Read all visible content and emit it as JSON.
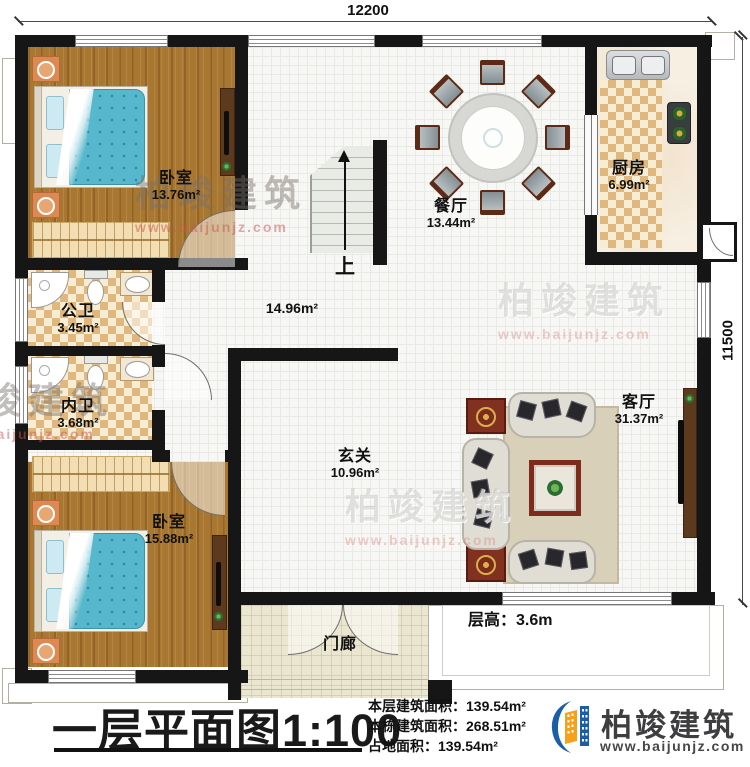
{
  "dimensions": {
    "top": "12200",
    "right": "11500"
  },
  "rooms": {
    "bedroom1": {
      "name": "卧室",
      "area": "13.76m²"
    },
    "bath_public": {
      "name": "公卫",
      "area": "3.45m²"
    },
    "bath_inner": {
      "name": "内卫",
      "area": "3.68m²"
    },
    "bedroom2": {
      "name": "卧室",
      "area": "15.88m²"
    },
    "dining": {
      "name": "餐厅",
      "area": "13.44m²"
    },
    "kitchen": {
      "name": "厨房",
      "area": "6.99m²"
    },
    "hall": {
      "area": "14.96m²"
    },
    "foyer": {
      "name": "玄关",
      "area": "10.96m²"
    },
    "living": {
      "name": "客厅",
      "area": "31.37m²"
    },
    "porch": {
      "name": "门廊"
    }
  },
  "stairs": {
    "up_label": "上"
  },
  "notes": {
    "floor_height_label": "层高：",
    "floor_height_value": "3.6m"
  },
  "title_block": {
    "title": "一层平面图",
    "scale": "1:100",
    "stats": [
      {
        "label": "本层建筑面积：",
        "value": "139.54m²"
      },
      {
        "label": "本栋建筑面积：",
        "value": "268.51m²"
      },
      {
        "label": "占地面积：",
        "value": "139.54m²"
      }
    ],
    "brand": {
      "name": "柏竣建筑",
      "url": "www.baijunjz.com"
    }
  },
  "watermark": {
    "text": "柏竣建筑",
    "url": "www.baijunjz.com"
  },
  "colors": {
    "wall": "#161616",
    "brand_blue": "#1b5ea8",
    "brand_orange": "#f6a01b",
    "wood": "#a87832",
    "tile_checker": "#e0b87e",
    "bed_blue": "#57b7cc"
  }
}
